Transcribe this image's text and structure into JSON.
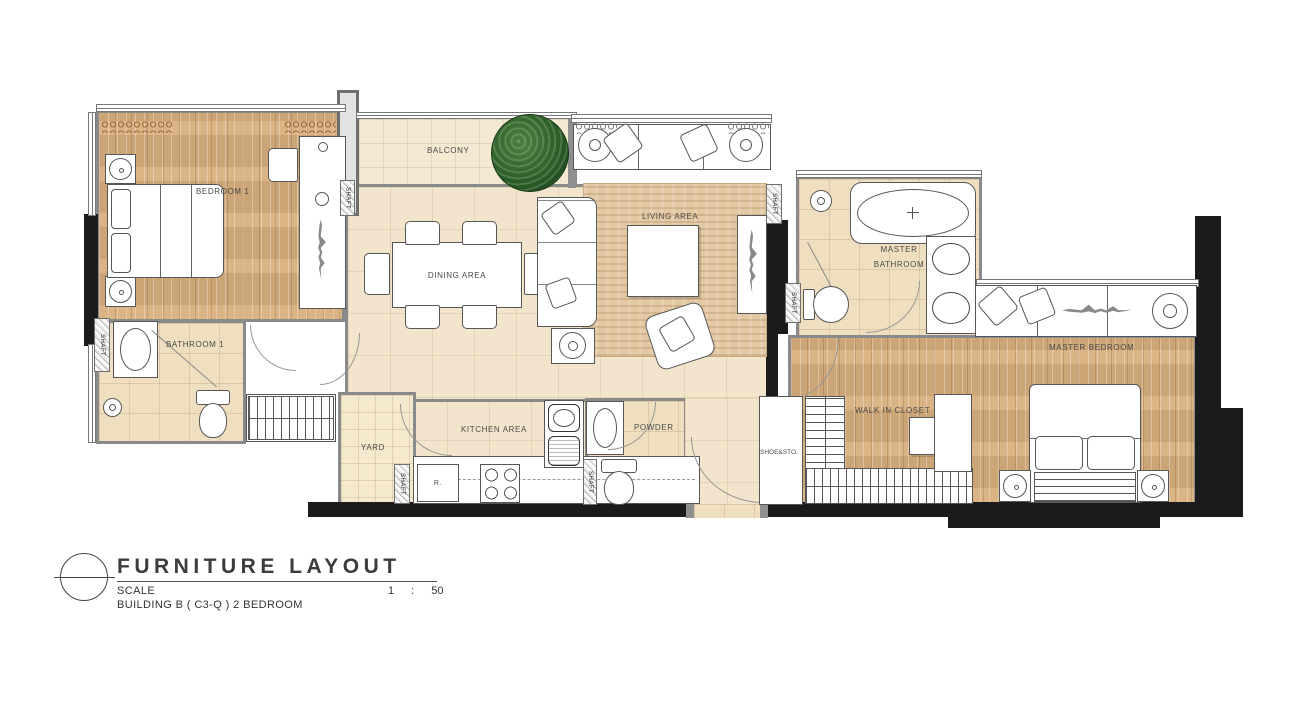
{
  "drawing": {
    "title": "FURNITURE LAYOUT",
    "scale_label": "SCALE",
    "scale_value": "1 : 50",
    "building_line": "BUILDING B ( C3-Q ) 2 BEDROOM"
  },
  "rooms": {
    "bedroom1": "BEDROOM 1",
    "bathroom1": "BATHROOM 1",
    "balcony": "BALCONY",
    "dining_area": "DINING AREA",
    "living_area": "LIVING AREA",
    "kitchen_area": "KITCHEN AREA",
    "yard": "YARD",
    "powder": "POWDER",
    "master_bathroom_line1": "MASTER",
    "master_bathroom_line2": "BATHROOM",
    "master_bedroom": "MASTER BEDROOM",
    "walk_in_closet": "WALK IN  CLOSET",
    "shoe_storage": "SHOE&STO.",
    "shaft": "SHAFT"
  },
  "appliances": {
    "refrigerator": "R."
  },
  "colors": {
    "wood_floor": "#d7ae7c",
    "tile_cream": "#f2e5cb",
    "tile_beige": "#efdfc0",
    "rug": "#e2c9a4",
    "wall_black": "#1b1b1b",
    "wall_grey": "#8f8f8f",
    "plant_green": "#2c5f28"
  }
}
